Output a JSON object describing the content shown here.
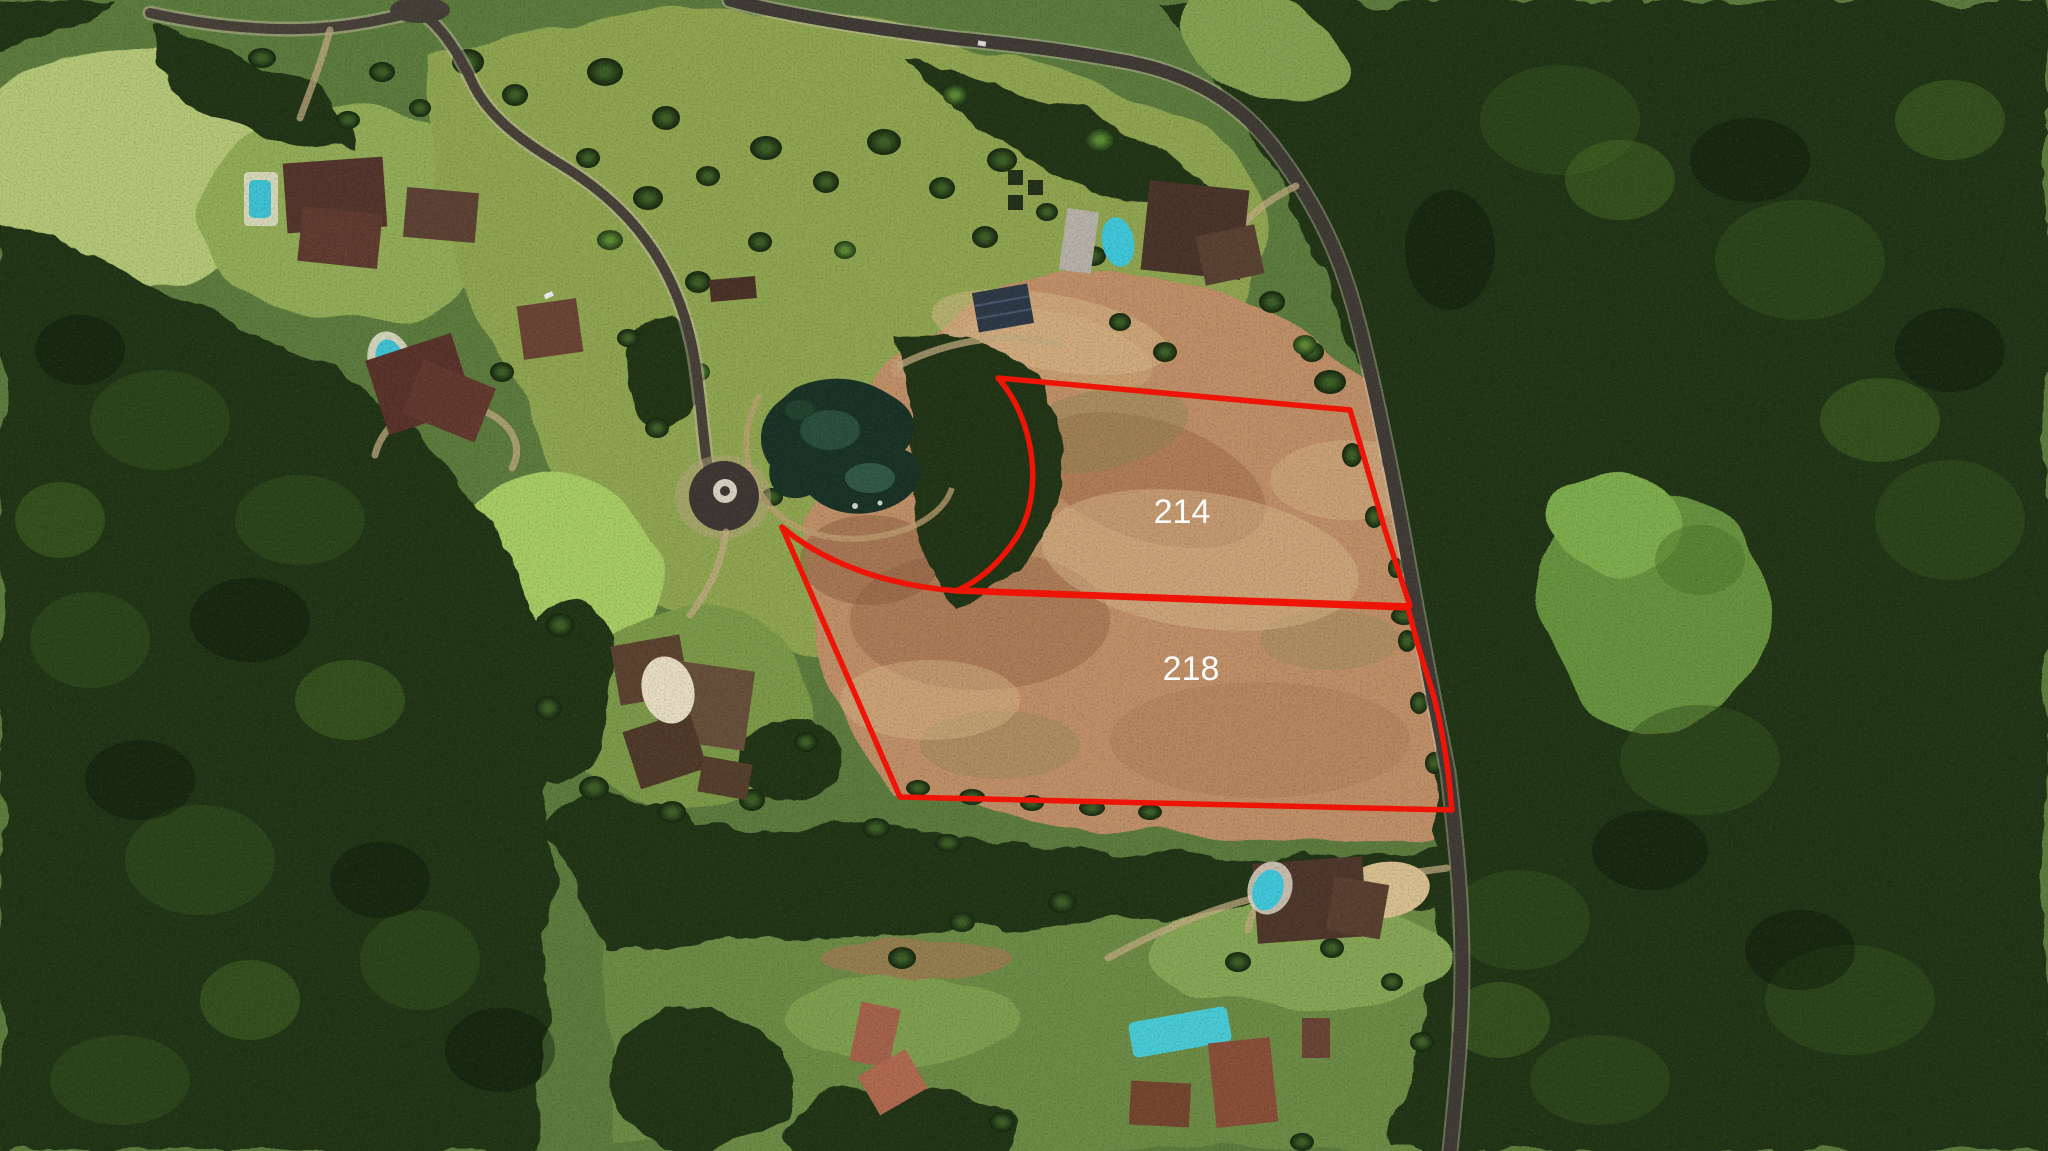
{
  "map": {
    "type": "aerial-satellite-photo",
    "scene": "hillside estate community with forest, pond, cul-de-sac, rural road and two outlined vacant parcels",
    "annotation": {
      "boundary_color": "#ee1407",
      "boundary_stroke_width": "5.5",
      "label_color": "#ffffff",
      "label_font_size": "34"
    },
    "parcels": [
      {
        "label": "214",
        "path": "M 998,378 L 1350,410 C 1362,450 1375,495 1385,530 C 1394,558 1403,585 1410,606 L 958,590 C 985,578 1005,556 1018,535 C 1043,494 1036,421 998,378 Z",
        "label_x": "1182",
        "label_y": "523"
      },
      {
        "label": "218",
        "path": "M 782,527 C 818,558 878,585 958,591 L 1408,608 C 1416,640 1424,666 1431,687 C 1438,710 1444,742 1448,772 L 1452,810 L 900,797 Z",
        "label_x": "1191",
        "label_y": "680"
      }
    ],
    "features": [
      "forest",
      "pasture",
      "dirt-field",
      "pond",
      "roundabout-cul-de-sac",
      "main-road",
      "residential-road",
      "driveways",
      "estate-houses",
      "swimming-pools",
      "solar-panels"
    ]
  }
}
